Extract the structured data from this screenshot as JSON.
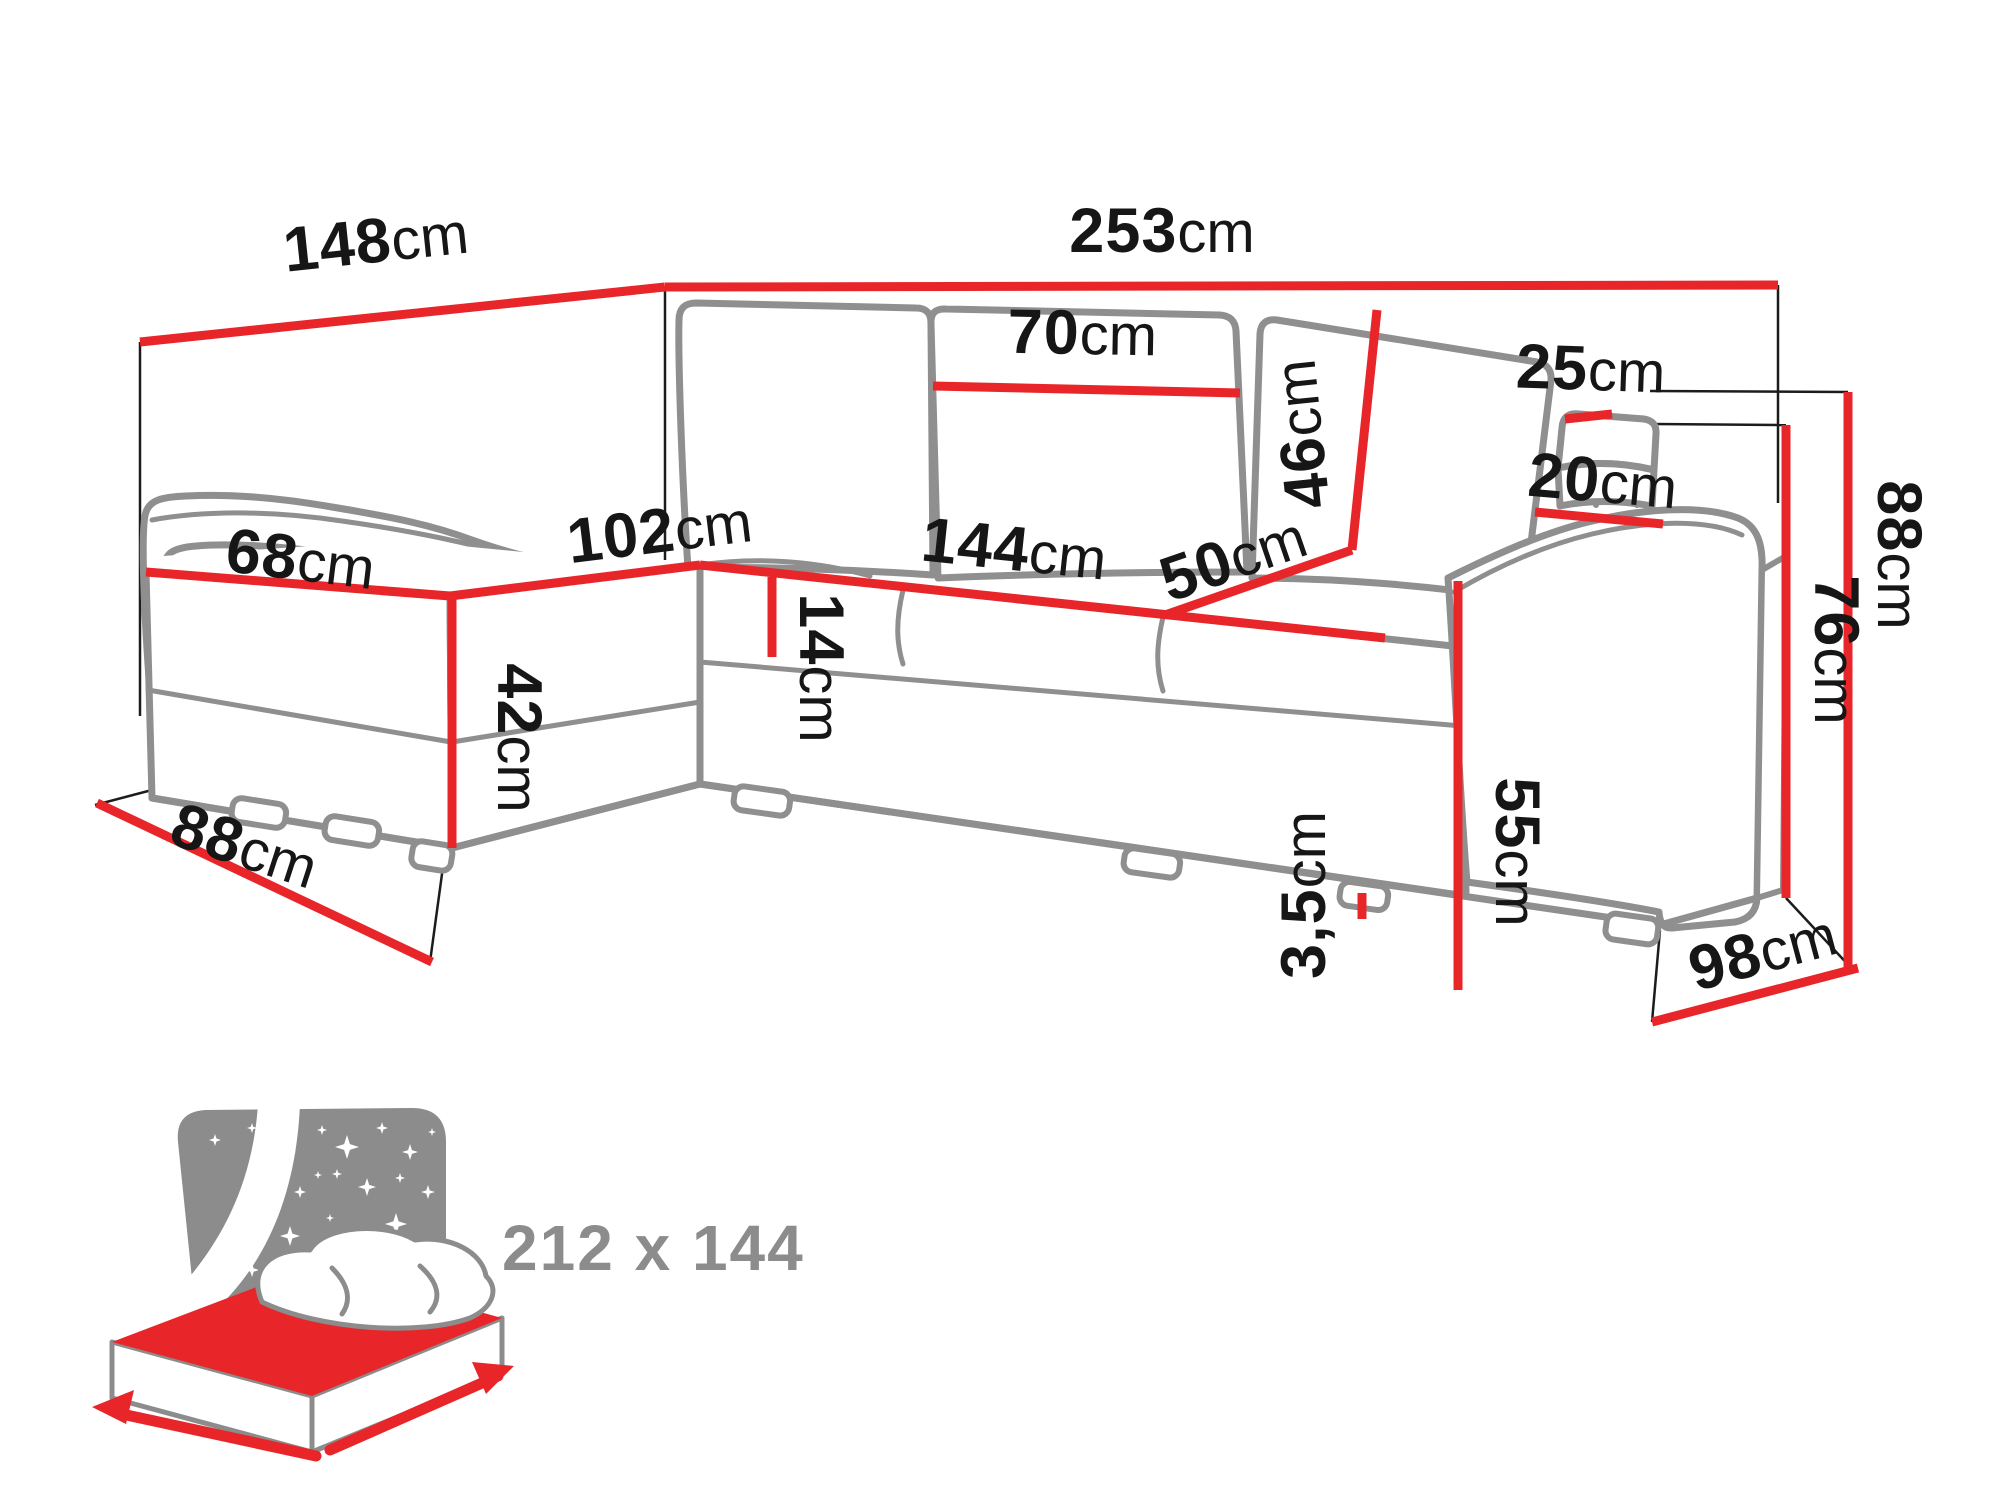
{
  "meta": {
    "background_color": "#ffffff",
    "dimension_line_color": "#e8262a",
    "sofa_outline_color": "#8f8f8f",
    "label_text_color": "#161616",
    "icon_color": "#8c8c8c"
  },
  "dimensions": {
    "back_width_left": {
      "num": "148",
      "unit": "cm"
    },
    "back_width_total": {
      "num": "253",
      "unit": "cm"
    },
    "back_cushion_width": {
      "num": "70",
      "unit": "cm"
    },
    "back_cushion_height": {
      "num": "46",
      "unit": "cm"
    },
    "armrest_top_pad_width": {
      "num": "25",
      "unit": "cm"
    },
    "armrest_top_width": {
      "num": "20",
      "unit": "cm"
    },
    "chaise_seat_width": {
      "num": "68",
      "unit": "cm"
    },
    "chaise_seat_length": {
      "num": "102",
      "unit": "cm"
    },
    "seat_length": {
      "num": "144",
      "unit": "cm"
    },
    "seat_depth": {
      "num": "50",
      "unit": "cm"
    },
    "seat_cushion_thickness": {
      "num": "14",
      "unit": "cm"
    },
    "seat_height": {
      "num": "42",
      "unit": "cm"
    },
    "chaise_floor_length": {
      "num": "88",
      "unit": "cm"
    },
    "armrest_front_height": {
      "num": "55",
      "unit": "cm"
    },
    "foot_height": {
      "num": "3,5",
      "unit": "cm"
    },
    "total_depth": {
      "num": "98",
      "unit": "cm"
    },
    "armrest_height": {
      "num": "76",
      "unit": "cm"
    },
    "total_height": {
      "num": "88",
      "unit": "cm"
    }
  },
  "sleeping_area": {
    "label": "212 x 144"
  }
}
